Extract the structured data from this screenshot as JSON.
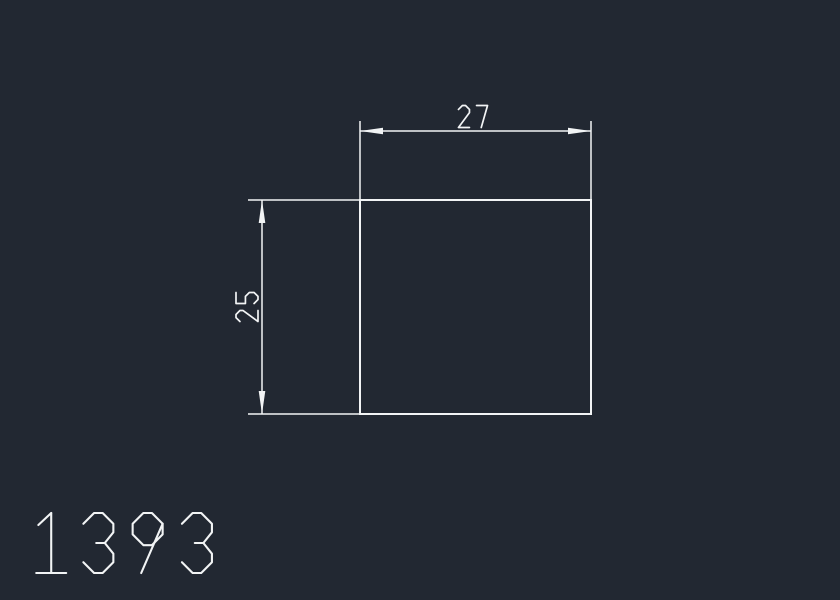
{
  "colors": {
    "background": "#222832",
    "line": "#f2f4f5"
  },
  "drawing": {
    "profile_number": "1393",
    "shape": "rectangle-profile",
    "dimensions": {
      "width": {
        "label": "27",
        "value": 27,
        "orientation": "horizontal"
      },
      "height": {
        "label": "25",
        "value": 25,
        "orientation": "vertical"
      }
    }
  }
}
